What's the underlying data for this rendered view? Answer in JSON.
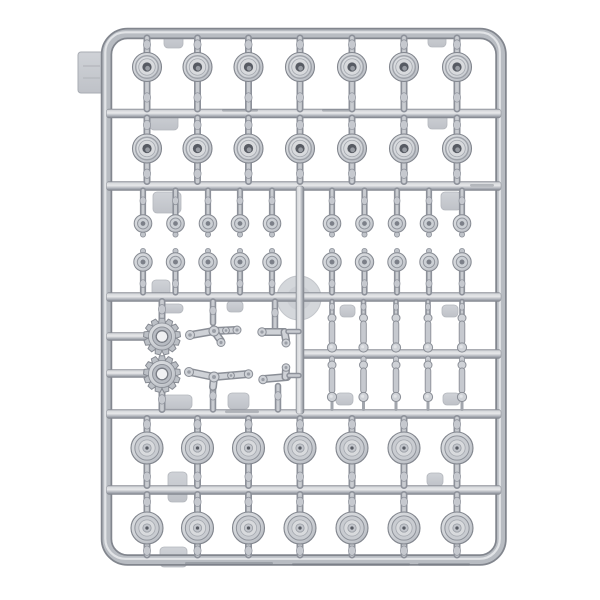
{
  "meta": {
    "description": "Photograph of a light grey injection-molded plastic model kit sprue (parts frame) on a white background, holding tank running-gear parts: two rows of seven open-hub road wheels at top, twenty small return rollers in the middle band, two toothed drive sprockets with suspension arms and levers at mid-left, ten shock-absorber links at mid-right, and two rows of seven dish-hub road wheels at the bottom.",
    "background": "#ffffff"
  },
  "palette": {
    "rail_dark": "#7c8089",
    "rail_edge": "#82868e",
    "rail_mid": "#b8bcc2",
    "rail_light": "#e7e8ea",
    "plastic_fill": "#cfd2d7",
    "plastic_line": "#8a8e96",
    "pad_fill": "#c9cdd2",
    "disc_fill": "#d4d7db",
    "hole_dark": "#575b63",
    "hub_white": "#f0f1f3"
  },
  "frame": {
    "x": 106.5,
    "y": 33.5,
    "w": 394.5,
    "h": 526.5,
    "radius": 21,
    "thickness": 10
  },
  "side_tab": {
    "x": 78,
    "y": 52,
    "w": 28,
    "h": 41
  },
  "gate_disc": {
    "cx": 299,
    "cy": 298,
    "r": 22
  },
  "rails_horizontal": [
    {
      "y": 113.5,
      "x1": 106.5,
      "x2": 501
    },
    {
      "y": 186,
      "x1": 106.5,
      "x2": 501
    },
    {
      "y": 297,
      "x1": 106.5,
      "x2": 501
    },
    {
      "y": 354,
      "x1": 300,
      "x2": 501
    },
    {
      "y": 414,
      "x1": 106.5,
      "x2": 501
    },
    {
      "y": 490,
      "x1": 106.5,
      "x2": 501
    }
  ],
  "rails_vertical": [
    {
      "x": 300,
      "y1": 186,
      "y2": 414
    }
  ],
  "stub_rails": [
    {
      "y": 336.5,
      "x1": 106.5,
      "x2": 148
    },
    {
      "y": 373.5,
      "x1": 106.5,
      "x2": 148
    }
  ],
  "wheel_columns": [
    147,
    197.5,
    248.5,
    300,
    352,
    404,
    457
  ],
  "wheel_rows": [
    {
      "label": "open-hub road wheels row 1",
      "style": "open_hub",
      "cy": 67,
      "r": 14.5,
      "stem_top": [
        38,
        53.5
      ],
      "stem_bottom": [
        109,
        81.5
      ],
      "count": 7
    },
    {
      "label": "open-hub road wheels row 2",
      "style": "open_hub",
      "cy": 148.5,
      "r": 14.5,
      "stem_top": [
        118,
        134.5
      ],
      "stem_bottom": [
        181.5,
        163
      ],
      "count": 7
    },
    {
      "label": "dish-hub road wheels row 3",
      "style": "dish_hub",
      "cy": 448,
      "r": 16,
      "stem_top": [
        418.5,
        432.5
      ],
      "stem_bottom": [
        485.5,
        464.5
      ],
      "count": 7
    },
    {
      "label": "dish-hub road wheels row 4",
      "style": "dish_hub",
      "cy": 528,
      "r": 16,
      "stem_top": [
        494.5,
        512
      ],
      "stem_bottom": [
        555,
        544.5
      ],
      "count": 7
    }
  ],
  "roller_xs": [
    143,
    175.5,
    208,
    240,
    272,
    332,
    364.5,
    397,
    429,
    462
  ],
  "roller_rows": [
    {
      "label": "return rollers upper row",
      "cy": 223.5,
      "r": 8.8,
      "stem": [
        190.5,
        215
      ],
      "nub_dy": 11,
      "count": 10
    },
    {
      "label": "return rollers lower row",
      "cy": 262,
      "r": 9.2,
      "stem": [
        292.5,
        271.5
      ],
      "nub_dy": -11,
      "count": 10
    }
  ],
  "sprockets": {
    "cx": 162,
    "centers_y": [
      336.5,
      374
    ],
    "teeth": 13,
    "r_outer": 18.5,
    "r_ring": 12,
    "r_hole": 5.8,
    "stems": [
      [
        301.5,
        320
      ],
      [
        392,
        409.5
      ]
    ],
    "count": 2
  },
  "shock_columns": [
    332,
    363.5,
    396,
    428,
    462
  ],
  "shock_rows": [
    {
      "rail_top": 301.5,
      "ball_top_y": 318,
      "body_top": 321,
      "body_bottom": 344,
      "ball_bottom_y": 347.5,
      "tip_to": 351
    },
    {
      "rail_top": 358.5,
      "ball_top_y": 365,
      "body_top": 368,
      "body_bottom": 393,
      "ball_bottom_y": 397,
      "tip_to": 409.5
    }
  ],
  "arms": [
    {
      "stem": {
        "x": 213,
        "y1": 301.5,
        "y2": 323
      },
      "segments": [
        [
          191,
          335,
          214,
          331
        ],
        [
          214,
          331,
          236,
          330
        ],
        [
          214,
          331,
          221,
          341
        ]
      ],
      "balls": [
        [
          190,
          335,
          4.5
        ],
        [
          237,
          330,
          4
        ],
        [
          221,
          342.5,
          4
        ],
        [
          214,
          331,
          5
        ],
        [
          226,
          330.5,
          3.4
        ]
      ]
    },
    {
      "stem": {
        "x": 213,
        "y1": 386,
        "y2": 409.5
      },
      "segments": [
        [
          190,
          372,
          214,
          377
        ],
        [
          214,
          377,
          248,
          374
        ],
        [
          214,
          377,
          213,
          387
        ]
      ],
      "balls": [
        [
          189,
          372,
          4.5
        ],
        [
          248.5,
          374,
          4.2
        ],
        [
          214,
          377,
          5
        ],
        [
          231,
          375.5,
          3.4
        ]
      ]
    }
  ],
  "levers": [
    {
      "stem": {
        "x": 275,
        "y1": 301.5,
        "y2": 328
      },
      "segments": [
        [
          263,
          332,
          284,
          332
        ],
        [
          284.5,
          332,
          286,
          340
        ]
      ],
      "balls": [
        [
          262,
          332,
          4.2
        ],
        [
          286,
          343,
          4
        ]
      ]
    },
    {
      "stem": {
        "x": 278,
        "y1": 386,
        "y2": 409.5
      },
      "segments": [
        [
          264,
          379,
          287,
          377
        ],
        [
          285.5,
          377,
          286,
          369
        ]
      ],
      "balls": [
        [
          263,
          379.5,
          4.2
        ],
        [
          286,
          367.5,
          3.8
        ]
      ]
    }
  ],
  "ejector_pads": [
    [
      164,
      32,
      19,
      16
    ],
    [
      428,
      32,
      18,
      15
    ],
    [
      150,
      110,
      28,
      20
    ],
    [
      428,
      112,
      19,
      17
    ],
    [
      153,
      192,
      28,
      21
    ],
    [
      441,
      192,
      20,
      18
    ],
    [
      152,
      280,
      18,
      18
    ],
    [
      160,
      304,
      23,
      9
    ],
    [
      227,
      301,
      16,
      11
    ],
    [
      340,
      305,
      15,
      12
    ],
    [
      442,
      305,
      16,
      12
    ],
    [
      228,
      393,
      21,
      16
    ],
    [
      336,
      393,
      17,
      12
    ],
    [
      443,
      393,
      17,
      12
    ],
    [
      163,
      395,
      29,
      14
    ],
    [
      168,
      472,
      19,
      30
    ],
    [
      427,
      473,
      16,
      13
    ],
    [
      160,
      547,
      27,
      20
    ]
  ],
  "rail_marks": [
    [
      222,
      109,
      36
    ],
    [
      322,
      109,
      30
    ],
    [
      470,
      184,
      24
    ],
    [
      225,
      410.5,
      34
    ],
    [
      185,
      562,
      88
    ],
    [
      292,
      563,
      118
    ],
    [
      418,
      563,
      52
    ]
  ]
}
